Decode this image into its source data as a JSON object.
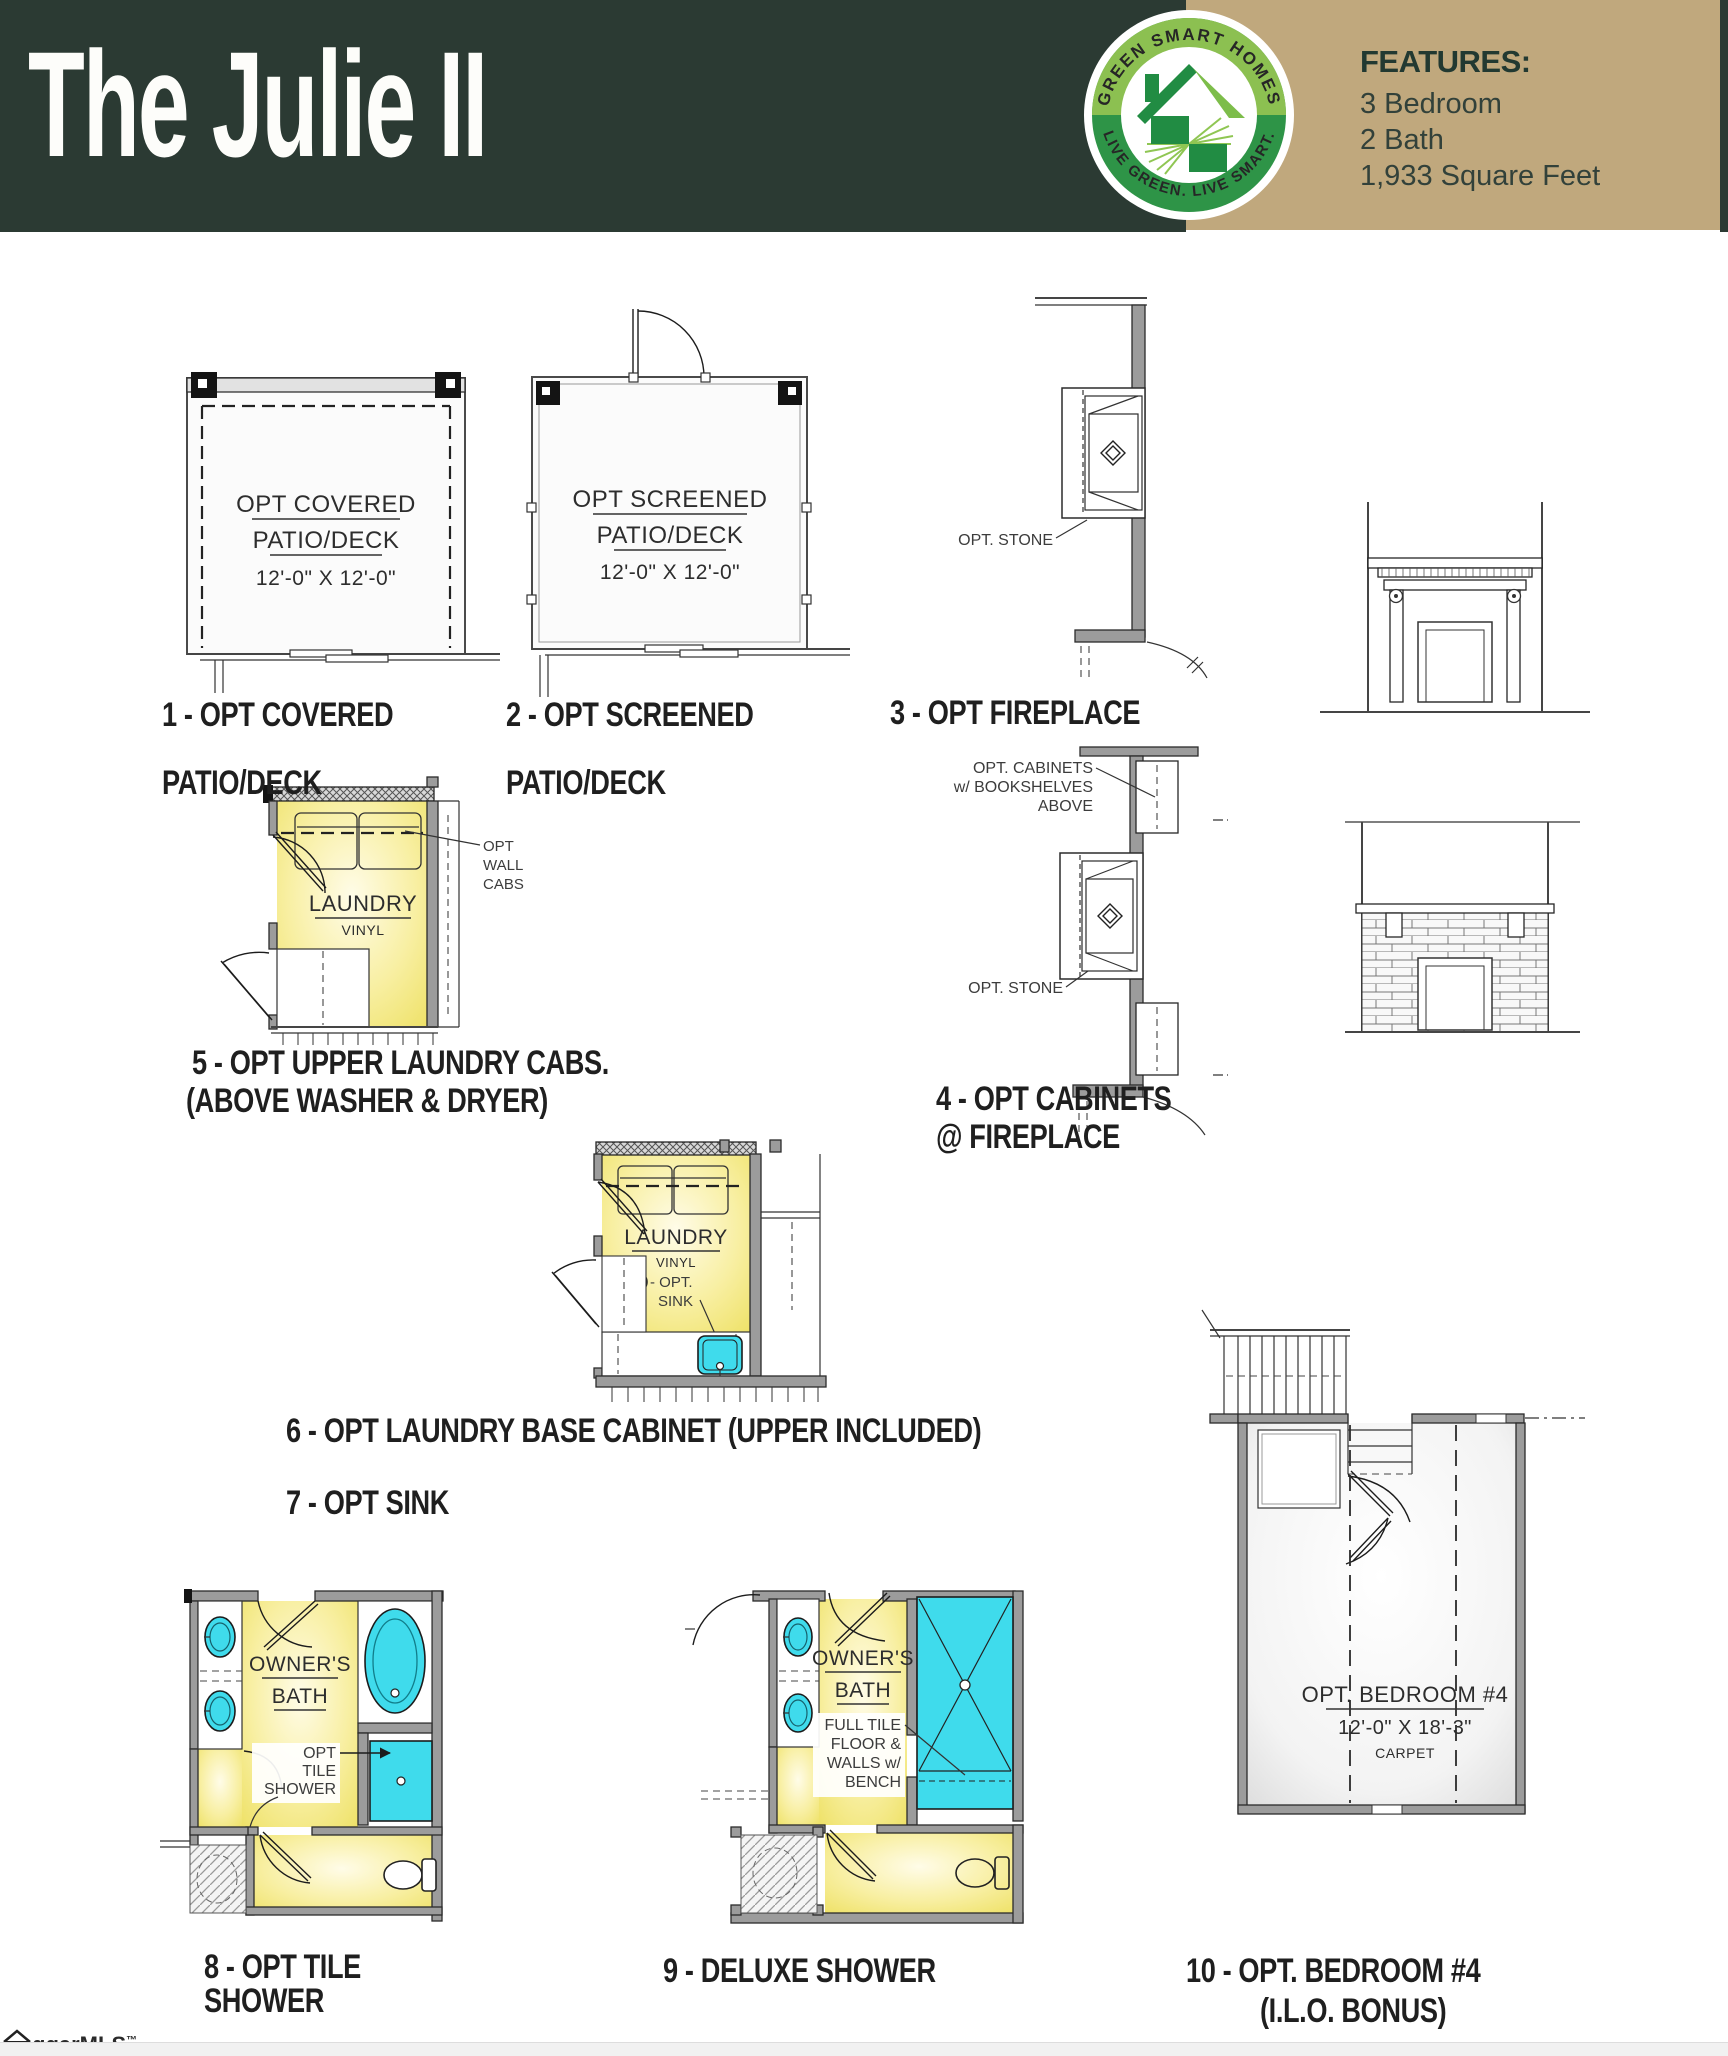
{
  "colors": {
    "header_green": "#2b3a33",
    "tan": "#c0a87d",
    "room_yellow": "#f2e87f",
    "fixture_cyan": "#3fdbec",
    "logo_light_green": "#8cc051",
    "logo_dark_green": "#2e9447"
  },
  "header": {
    "title": "The Julie II",
    "logo": {
      "arc_top": "GREEN SMART HOMES",
      "arc_bottom": "LIVE GREEN. LIVE SMART.",
      "icon": "house-icon"
    },
    "features": {
      "heading": "FEATURES:",
      "items": [
        "3 Bedroom",
        "2 Bath",
        "1,933 Square Feet"
      ]
    }
  },
  "diagrams": {
    "d1": {
      "label1": "OPT COVERED",
      "label2": "PATIO/DECK",
      "dims": "12'-0\" X 12'-0\"",
      "cap1": "1 - OPT COVERED",
      "cap2": "PATIO/DECK"
    },
    "d2": {
      "label1": "OPT SCREENED",
      "label2": "PATIO/DECK",
      "dims": "12'-0\" X 12'-0\"",
      "cap1": "2 - OPT SCREENED",
      "cap2": "PATIO/DECK"
    },
    "d3": {
      "ann_stone": "OPT. STONE",
      "cap": "3 - OPT FIREPLACE"
    },
    "d4": {
      "ann_cab1": "OPT. CABINETS",
      "ann_cab2": "w/ BOOKSHELVES",
      "ann_cab3": "ABOVE",
      "ann_stone": "OPT. STONE",
      "cap1": "4 - OPT CABINETS",
      "cap2": "@ FIREPLACE"
    },
    "d5": {
      "room": "LAUNDRY",
      "floor": "VINYL",
      "ann1": "OPT",
      "ann2": "WALL",
      "ann3": "CABS",
      "cap1": "5 - OPT UPPER LAUNDRY CABS.",
      "cap2": "(ABOVE WASHER & DRYER)"
    },
    "d6": {
      "room": "LAUNDRY",
      "floor": "VINYL",
      "sink_num": "7",
      "sink_ann1": "- OPT.",
      "sink_ann2": "SINK",
      "cap1": "6 - OPT LAUNDRY BASE CABINET (UPPER INCLUDED)",
      "cap2": "7 - OPT SINK"
    },
    "d8": {
      "room1": "OWNER'S",
      "room2": "BATH",
      "ann1": "OPT",
      "ann2": "TILE",
      "ann3": "SHOWER",
      "cap1": "8 - OPT TILE",
      "cap2": "SHOWER"
    },
    "d9": {
      "room1": "OWNER'S",
      "room2": "BATH",
      "ann1": "FULL TILE",
      "ann2": "FLOOR &",
      "ann3": "WALLS w/",
      "ann4": "BENCH",
      "cap": "9 - DELUXE SHOWER"
    },
    "d10": {
      "room": "OPT. BEDROOM #4",
      "dims": "12'-0\" X 18'-3\"",
      "floor": "CARPET",
      "cap1": "10 - OPT. BEDROOM #4",
      "cap2": "(I.L.O. BONUS)"
    }
  },
  "watermark": {
    "text": "ggarMLS",
    "tm": "™"
  }
}
